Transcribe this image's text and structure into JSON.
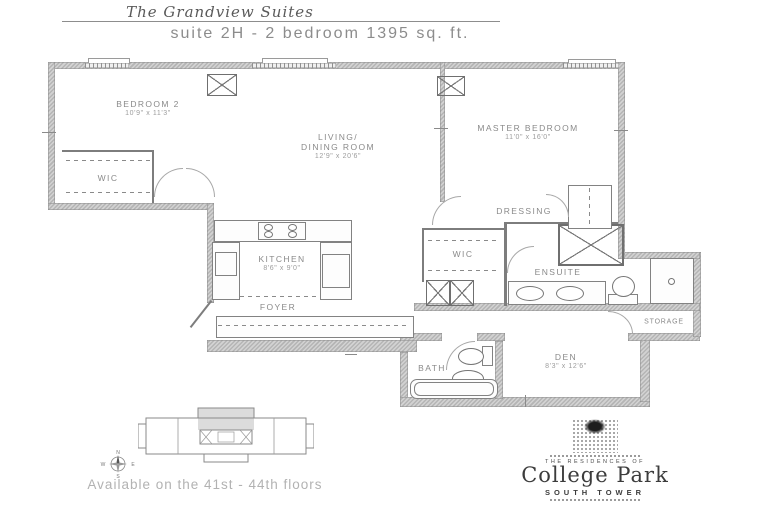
{
  "header": {
    "brand": "The Grandview Suites",
    "suite_line": "suite 2H - 2 bedroom 1395 sq. ft."
  },
  "rooms": {
    "bedroom2": {
      "name": "BEDROOM 2",
      "dims": "10'9\" x 11'3\""
    },
    "wic1": {
      "name": "WIC"
    },
    "living": {
      "name1": "LIVING/",
      "name2": "DINING ROOM",
      "dims": "12'9\" x 20'6\""
    },
    "master": {
      "name": "MASTER BEDROOM",
      "dims": "11'0\" x 16'0\""
    },
    "dressing": {
      "name": "DRESSING"
    },
    "wic2": {
      "name": "WIC"
    },
    "ensuite": {
      "name": "ENSUITE"
    },
    "kitchen": {
      "name": "KITCHEN",
      "dims": "8'6\" x 9'0\""
    },
    "foyer": {
      "name": "FOYER"
    },
    "bath": {
      "name": "BATH"
    },
    "den": {
      "name": "DEN",
      "dims": "8'3\" x 12'6\""
    },
    "storage": {
      "name": "STORAGE"
    }
  },
  "keyplan": {
    "availability": "Available on the 41st - 44th floors",
    "compass": {
      "n": "N",
      "s": "S",
      "e": "E",
      "w": "W"
    }
  },
  "logo": {
    "pre": "THE RESIDENCES OF",
    "name": "College Park",
    "sub": "SOUTH TOWER"
  },
  "disclaimer": {
    "line1": "Plans and specifications are approximate and are subject to change without notice.",
    "line2": "Actual usable floor space may vary from the stated floor area. E. & O.E."
  },
  "colors": {
    "wall": "#b5b5b5",
    "line": "#7d7d7d",
    "label": "#8a8a8a"
  }
}
